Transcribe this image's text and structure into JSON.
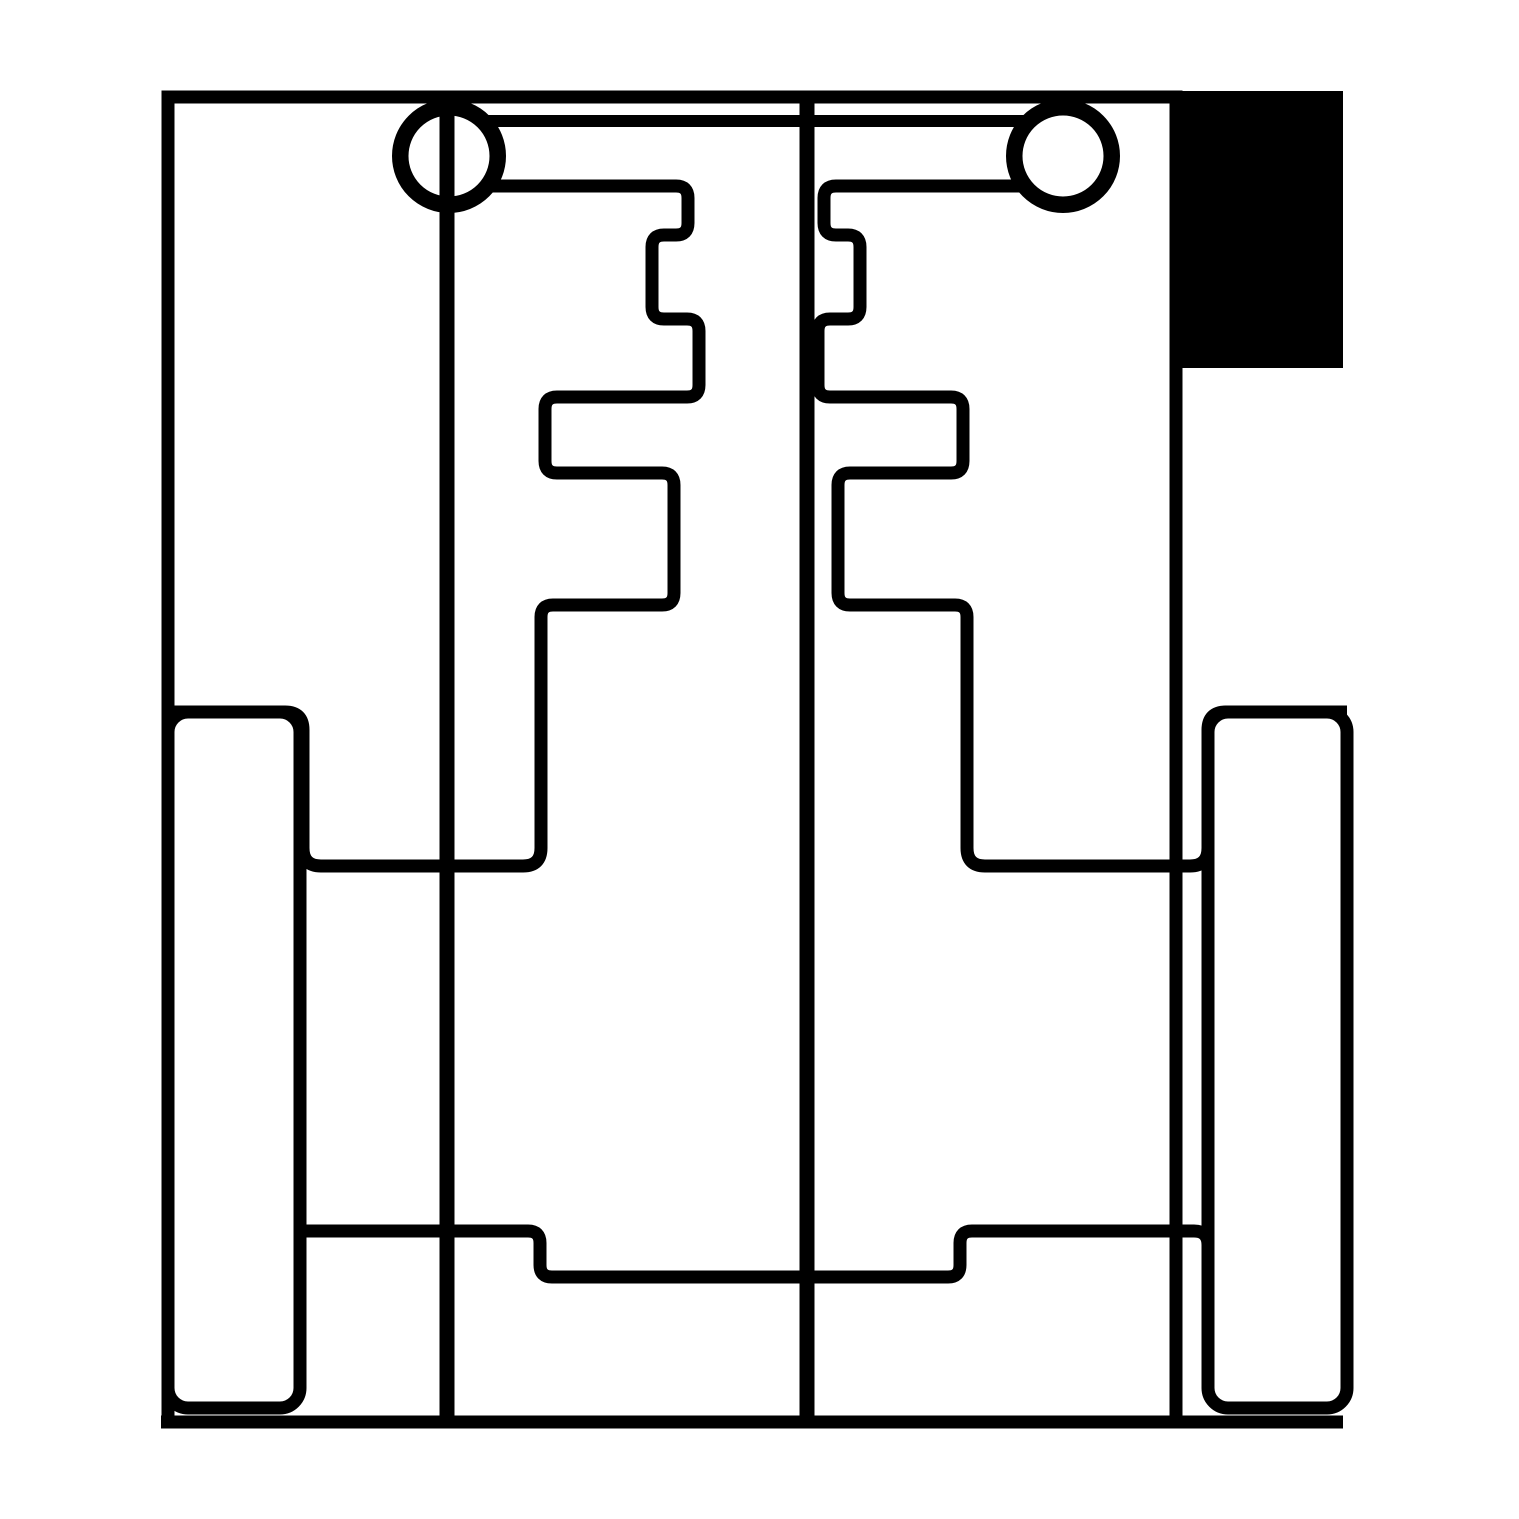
{
  "canvas": {
    "width": 1519,
    "height": 1519,
    "background": "#ffffff"
  },
  "palette": {
    "ink": "#000000",
    "background": "#ffffff"
  },
  "drawing": {
    "kind": "monochrome-technical-line-drawing",
    "stroke_default": 13,
    "shapes": [
      {
        "name": "outer-frame",
        "tag": "path",
        "attrs": {
          "d": "M 168 1422 V 97 H 1176 V 1422 M 161 1422 H 1343",
          "fill": "none",
          "stroke": "#000000",
          "stroke-width": "13"
        }
      },
      {
        "name": "corner-block-filled",
        "tag": "rect",
        "attrs": {
          "x": "1170",
          "y": "91",
          "width": "173",
          "height": "277",
          "fill": "#000000",
          "stroke": "none"
        }
      },
      {
        "name": "axle-line-left",
        "tag": "path",
        "attrs": {
          "d": "M 447 97 V 1420",
          "fill": "none",
          "stroke": "#000000",
          "stroke-width": "15"
        }
      },
      {
        "name": "axle-line-center",
        "tag": "path",
        "attrs": {
          "d": "M 807 97 V 1420",
          "fill": "none",
          "stroke": "#000000",
          "stroke-width": "15"
        }
      },
      {
        "name": "top-bar",
        "tag": "path",
        "attrs": {
          "d": "M 482 121 H 1030",
          "fill": "none",
          "stroke": "#000000",
          "stroke-width": "12"
        }
      },
      {
        "name": "wheel-left-ring",
        "tag": "circle",
        "attrs": {
          "cx": "449",
          "cy": "156",
          "r": "50",
          "fill": "none",
          "stroke": "#000000",
          "stroke-width": "14"
        }
      },
      {
        "name": "wheel-left-inner-ring",
        "tag": "circle",
        "attrs": {
          "cx": "449",
          "cy": "156",
          "r": "42",
          "fill": "none",
          "stroke": "#000000",
          "stroke-width": "3"
        }
      },
      {
        "name": "wheel-right-ring",
        "tag": "circle",
        "attrs": {
          "cx": "1063",
          "cy": "156",
          "r": "50",
          "fill": "none",
          "stroke": "#000000",
          "stroke-width": "14"
        }
      },
      {
        "name": "wheel-right-inner-ring",
        "tag": "circle",
        "attrs": {
          "cx": "1063",
          "cy": "156",
          "r": "42",
          "fill": "none",
          "stroke": "#000000",
          "stroke-width": "3"
        }
      },
      {
        "name": "comb-path-left",
        "tag": "path",
        "attrs": {
          "d": "M 486 186 H 676 Q 688 186 688 198 V 223 Q 688 235 676 235 H 664 Q 652 235 652 247 V 307 Q 652 319 664 319 H 687 Q 699 319 699 331 V 385 Q 699 397 687 397 H 557 Q 545 397 545 409 V 461 Q 545 473 557 473 H 662 Q 674 473 674 485 V 593 Q 674 605 662 605 H 553 Q 541 605 541 617 V 848 Q 541 866 523 866 H 321 Q 303 866 303 848 V 730 Q 303 712 285 712 H 168",
          "fill": "none",
          "stroke": "#000000",
          "stroke-width": "13"
        }
      },
      {
        "name": "comb-path-right",
        "tag": "path",
        "attrs": {
          "d": "M 1026 186 H 836 Q 824 186 824 198 V 223 Q 824 235 836 235 H 848 Q 860 235 860 247 V 307 Q 860 319 848 319 H 830 Q 818 319 818 331 V 385 Q 818 397 830 397 H 951 Q 963 397 963 409 V 461 Q 963 473 951 473 H 850 Q 838 473 838 485 V 593 Q 838 605 850 605 H 955 Q 967 605 967 617 V 848 Q 967 866 985 866 H 1190 Q 1208 866 1208 848 V 730 Q 1208 712 1226 712 H 1347",
          "fill": "none",
          "stroke": "#000000",
          "stroke-width": "13"
        }
      },
      {
        "name": "side-pill-left",
        "tag": "rect",
        "attrs": {
          "x": "168",
          "y": "712",
          "width": "132",
          "height": "696",
          "rx": "20",
          "ry": "20",
          "fill": "none",
          "stroke": "#000000",
          "stroke-width": "13"
        }
      },
      {
        "name": "side-pill-right",
        "tag": "rect",
        "attrs": {
          "x": "1208",
          "y": "712",
          "width": "139",
          "height": "696",
          "rx": "20",
          "ry": "20",
          "fill": "none",
          "stroke": "#000000",
          "stroke-width": "13"
        }
      },
      {
        "name": "bottom-step-line",
        "tag": "path",
        "attrs": {
          "d": "M 303 1231 H 528 Q 540 1231 540 1243 V 1265 Q 540 1277 552 1277 H 948 Q 960 1277 960 1265 V 1243 Q 960 1231 972 1231 H 1194 Q 1208 1231 1208 1245 V 1258",
          "fill": "none",
          "stroke": "#000000",
          "stroke-width": "13"
        }
      }
    ]
  }
}
